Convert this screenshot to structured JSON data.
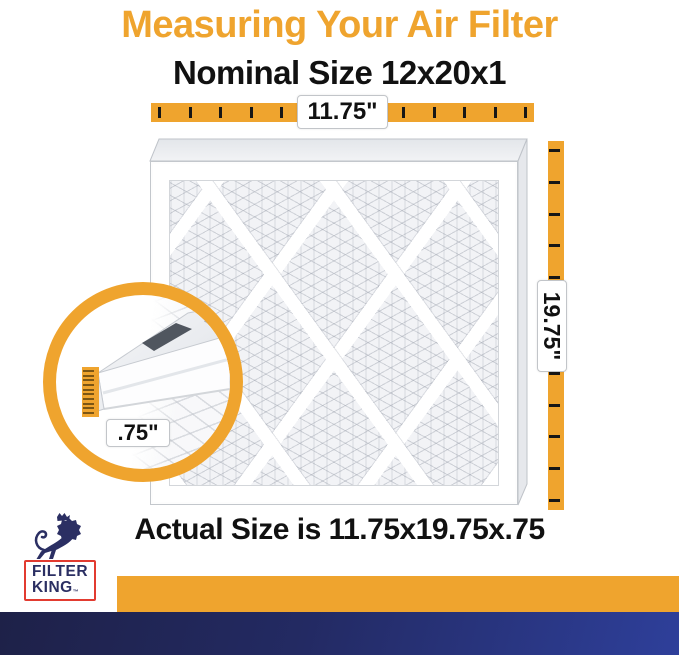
{
  "colors": {
    "orange": "#EFA42E",
    "ink": "#111111",
    "navy_dark": "#1E2148",
    "navy_bright": "#2E3F9A",
    "logo_navy": "#2B2F63",
    "logo_red": "#E23B30",
    "frame_gray": "#C6CAD0"
  },
  "header": {
    "title": "Measuring Your Air Filter",
    "nominal": "Nominal Size 12x20x1"
  },
  "measure": {
    "top": {
      "label": "11.75\"",
      "ticks": 13
    },
    "right": {
      "label": "19.75\"",
      "ticks": 12
    },
    "inset": {
      "label": ".75\"",
      "ticks": 10
    }
  },
  "footer": {
    "actual": "Actual Size is 11.75x19.75x.75"
  },
  "logo": {
    "line1": "FILTER",
    "line2": "KING",
    "tm": "™"
  }
}
